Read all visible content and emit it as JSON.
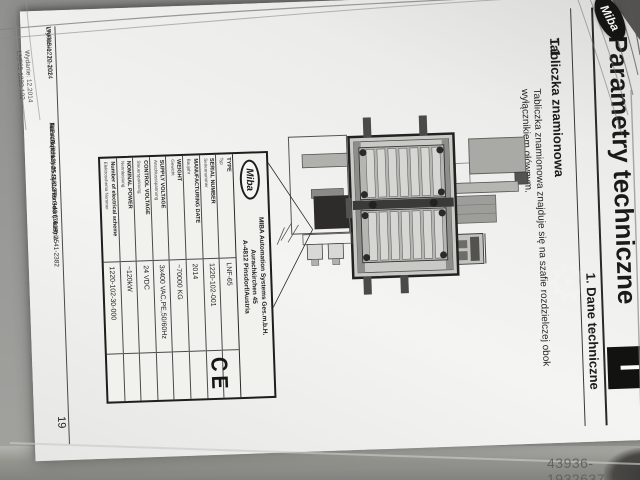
{
  "photo": {
    "watermark_id": "43936-1932637",
    "watermark_gear_icon": "gear"
  },
  "page": {
    "logo": "Miba",
    "header": {
      "title": "Parametry techniczne",
      "subtitle": "1. Dane techniczne",
      "chapter_marker": "I"
    },
    "section": {
      "number": "1.1",
      "heading": "Tabliczka znamionowa",
      "body_line1": "Tabliczka znamionowa znajduje się na szafie rozdzielczej obok",
      "body_line2": "wyłącznikiem głównym."
    },
    "nameplate": {
      "logo": "Miba",
      "company_line1": "MIBA Automation Systems Ges.m.b.H.",
      "company_line2": "Aurachkirchen 45",
      "company_line3": "A-4812 Pinsdorf/Austria",
      "ce_mark": "CE",
      "rows": [
        {
          "label": "TYPE",
          "sublabel": "Typ",
          "value": "LNF-65"
        },
        {
          "label": "SERIAL NUMBER",
          "sublabel": "Seriennummer",
          "value": "1220-102-001"
        },
        {
          "label": "MANUFACTURING DATE",
          "sublabel": "Baujahr",
          "value": "2014"
        },
        {
          "label": "WEIGHT",
          "sublabel": "Gewicht",
          "value": "~70000 KG"
        },
        {
          "label": "SUPPLY VOLTAGE",
          "sublabel": "Anschlussspannung",
          "value": "3x400 VAC,PE,50/60Hz"
        },
        {
          "label": "CONTROL VOLTAGE",
          "sublabel": "Steuerspannung",
          "value": "24 VDC"
        },
        {
          "label": "NOMINAL POWER",
          "sublabel": "Nennleistung",
          "value": "~120kW"
        },
        {
          "label": "Number of electrical scheme",
          "sublabel": "Elektroschema Nummer",
          "value": "1220-102-30-000"
        }
      ]
    },
    "footer": {
      "edition_line1": "Wydanie: 12.2014",
      "edition_line2": "LNF65-1220-102",
      "company_line1": "MIBA Automation Systems Ges.m.b.H.",
      "company_line2": "Aurachkirchen 45, 4812 Pinsdorf, Austria",
      "company_line3": "Tel +43 (7613) 2541-0, Fax +43 (7613) 2541-2382",
      "page_number": "19"
    }
  },
  "colors": {
    "paper": "#f4f4f2",
    "ink": "#1c1c1a",
    "surface": "#9a9a98",
    "chapter_box": "#121210"
  }
}
